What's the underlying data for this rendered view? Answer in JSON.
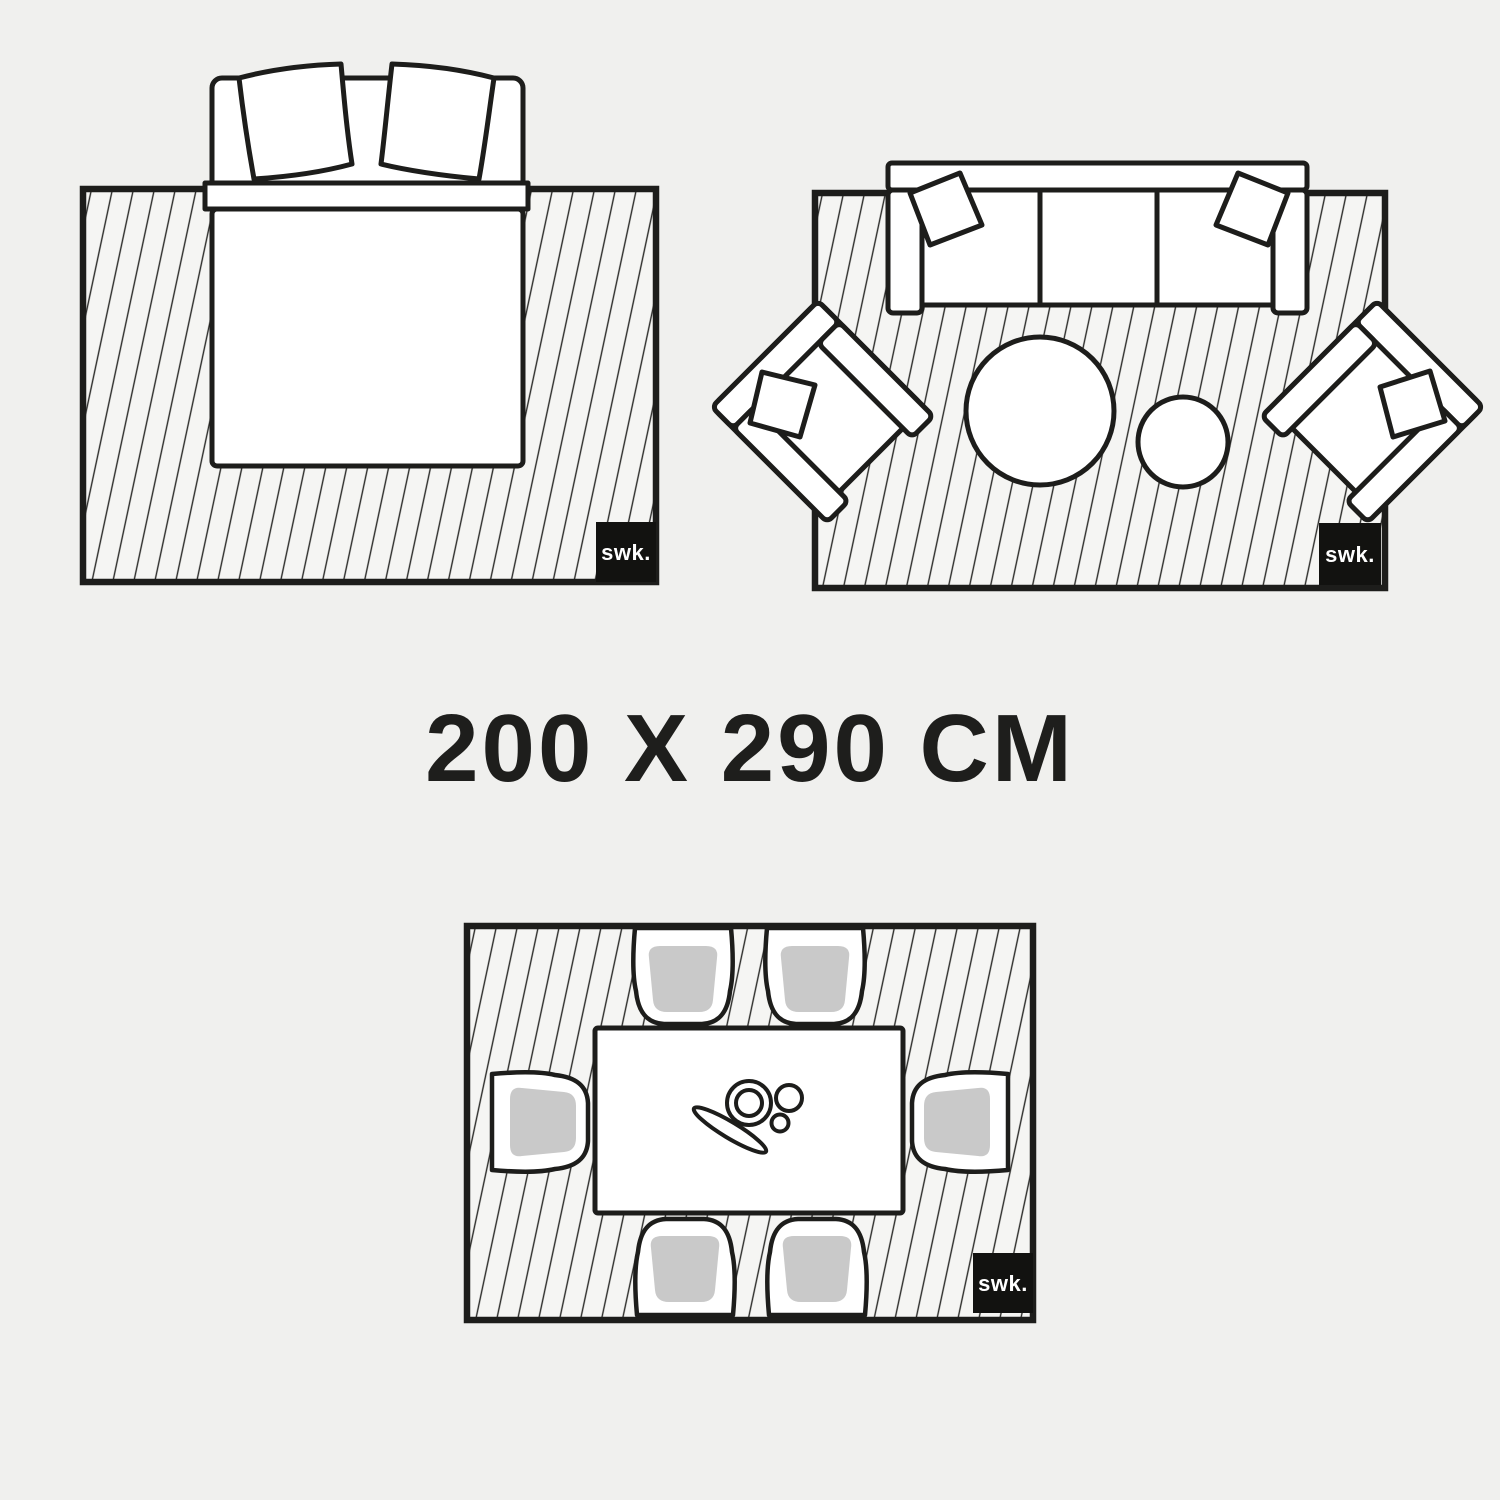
{
  "page": {
    "background_color": "#f0f0ee",
    "description": "Rug size guide showing one rug size in three rooms: bedroom with double bed, living room with sofa, armchairs and coffee tables, dining room with table and six chairs"
  },
  "size_label": "200 X 290 CM",
  "brand_logo": {
    "text": "swk.",
    "background_color": "#121210",
    "text_color": "#ffffff"
  },
  "diagrams": {
    "bedroom": {
      "label": "swk."
    },
    "living_room": {
      "label": "swk."
    },
    "dining_room": {
      "label": "swk."
    }
  },
  "colors": {
    "outline": "#1d1d1b",
    "rug_fill": "#f5f5f3",
    "hatch_line": "#2b2b29",
    "furniture_fill": "#ffffff",
    "chair_seat_gray": "#c9c9c9"
  }
}
